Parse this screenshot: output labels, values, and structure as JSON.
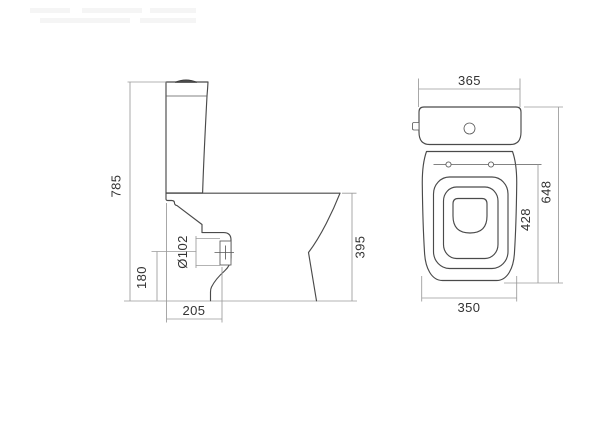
{
  "drawing": {
    "colors": {
      "outline": "#4a4a4a",
      "dimension": "#9a9a9a",
      "label": "#333333",
      "background": "#ffffff"
    },
    "views": {
      "side": {
        "dimensions": {
          "overall_height": "785",
          "outlet_center_height": "180",
          "outlet_diameter": "Ø102",
          "outlet_center_setout": "205",
          "rim_height": "395"
        }
      },
      "front": {
        "dimensions": {
          "cistern_width": "365",
          "overall_height": "648",
          "hinge_height": "428",
          "base_width": "350"
        }
      }
    }
  }
}
